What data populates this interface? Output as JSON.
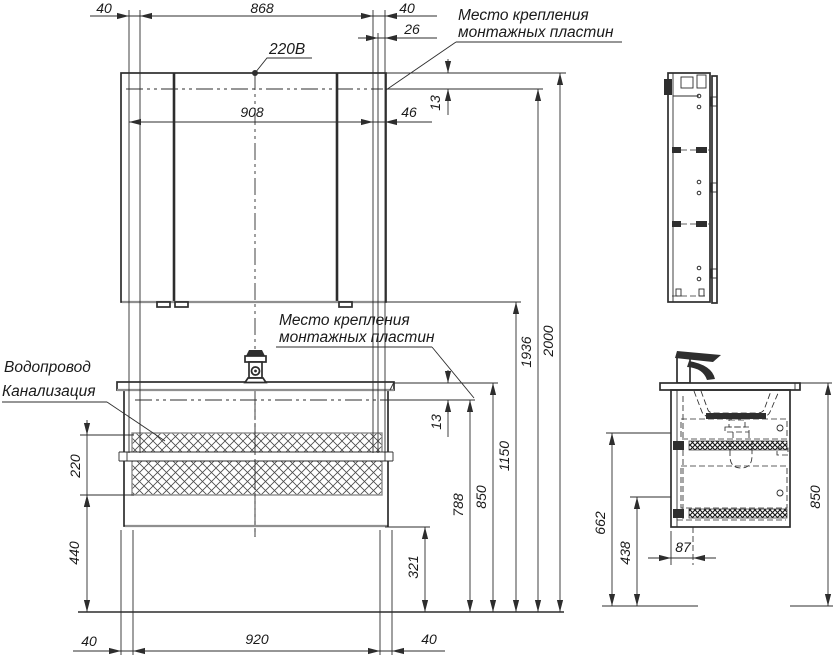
{
  "labels": {
    "power": "220В",
    "mounting_top": {
      "line1": "Место крепления",
      "line2": "монтажных пластин"
    },
    "mounting_mid": {
      "line1": "Место крепления",
      "line2": "монтажных пластин"
    },
    "water": "Водопровод",
    "sewer": "Канализация"
  },
  "dims": {
    "top_left_40": "40",
    "top_868": "868",
    "top_right_40": "40",
    "top_26": "26",
    "mirror_908": "908",
    "mirror_46": "46",
    "mirror_13": "13",
    "h_2000": "2000",
    "h_1936": "1936",
    "h_1150": "1150",
    "h_850": "850",
    "h_788": "788",
    "h_13": "13",
    "hatch_220": "220",
    "left_440": "440",
    "right_321": "321",
    "bot_left_40": "40",
    "bot_920": "920",
    "bot_right_40": "40",
    "side_850": "850",
    "side_662": "662",
    "side_438": "438",
    "side_87": "87"
  },
  "colors": {
    "ink": "#2d2d2d",
    "gray_edge": "#8f8f8f",
    "background": "#ffffff"
  }
}
